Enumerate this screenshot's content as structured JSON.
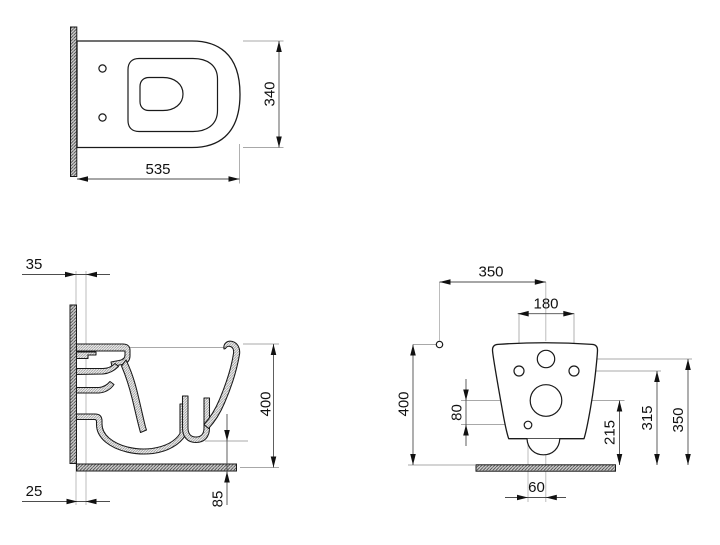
{
  "drawing": {
    "title": "wall-hung WC technical drawing, three views",
    "colors": {
      "line": "#1a1a1a",
      "dimension": "#4d4d4d",
      "extension": "#a8a8a8",
      "background": "#ffffff"
    },
    "views": {
      "top": {
        "width": "535",
        "depth": "340"
      },
      "side": {
        "wall_offset": "35",
        "floor_offset": "25",
        "height": "400",
        "outlet_clearance": "85"
      },
      "rear": {
        "fixing_offset": "350",
        "bolt_spacing": "180",
        "height": "400",
        "drain_to_hole": "80",
        "drain_height": "215",
        "bolt_height": "315",
        "inlet_height": "350",
        "hole_offset": "60"
      }
    }
  }
}
